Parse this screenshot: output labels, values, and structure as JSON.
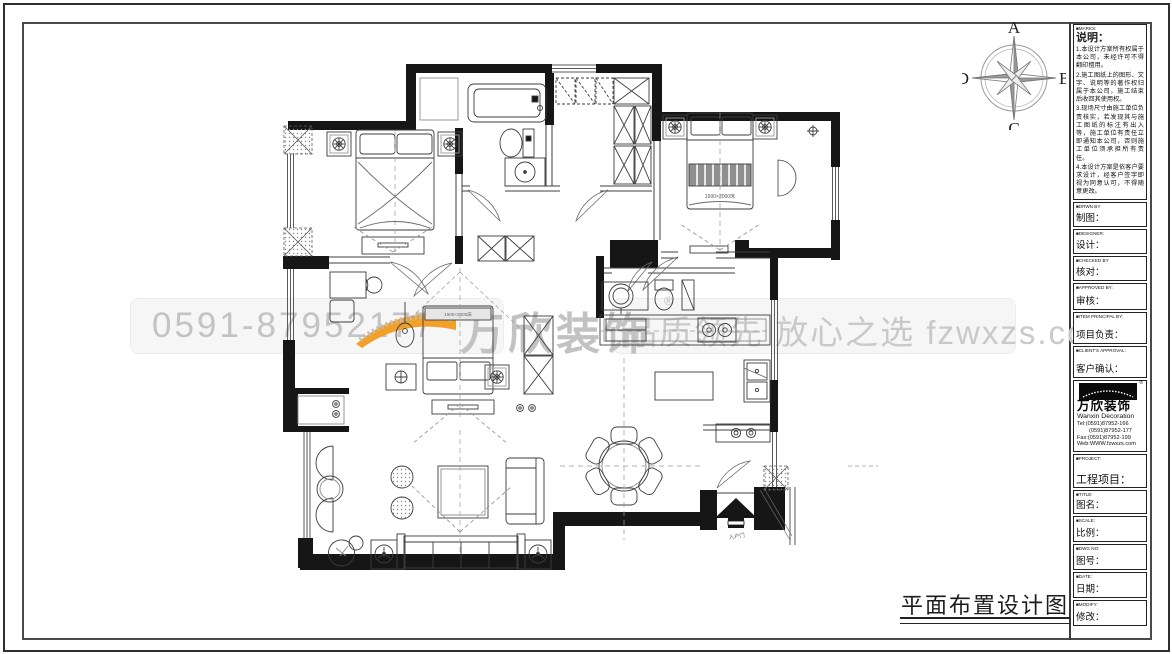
{
  "watermark": {
    "phone": "0591-87952177",
    "slogan": "品质领先 放心之选 fzwxzs.com",
    "logo_text": "万欣装饰",
    "reg_mark": "®",
    "accent_color": "#f3a028",
    "text_color": "#c3c3c3"
  },
  "compass": {
    "n": "A",
    "e": "B",
    "s": "C",
    "w": "D"
  },
  "drawing": {
    "title": "平面布置设计图",
    "bed_label": "1500×2000床",
    "bed_label2": "1500×2000床",
    "entrance_label": "入户门"
  },
  "titleblock": {
    "notes": {
      "en": "■MARKS:",
      "zh": "说明：",
      "items": [
        "1.本设计方案所有权属于本公司，未经许可不得翻印擅用。",
        "2.施工图纸上的图形、文字、说明等的著作权归属于本公司，施工结束后收回其使用权。",
        "3.现场尺寸由施工单位负责核实，若发现其与施工图纸的标注有出入等，施工单位有责任立即通知本公司，否则施工单位须承担所有责任。",
        "4.本设计方案是依客户要求设计，经客户签字即视为同意认可，不得随意更改。"
      ]
    },
    "fields": [
      {
        "en": "■DRWN BY",
        "zh": "制图："
      },
      {
        "en": "■DESIGNER:",
        "zh": "设计："
      },
      {
        "en": "■CHECKED BY",
        "zh": "核对："
      },
      {
        "en": "■APPROVED BY:",
        "zh": "审核："
      },
      {
        "en": "■ITEM PRINCIPAL BY:",
        "zh": "项目负责："
      },
      {
        "en": "■CLIENT'S APPROVAL:",
        "zh": "客户确认："
      }
    ],
    "company": {
      "logo_cn": "万欣装饰",
      "logo_en": "Wanxin Decoration",
      "reg": "®",
      "tel1": "Tel:(0591)87952-166",
      "tel2": "(0591)87952-177",
      "fax": "Fax:(0591)87952-199",
      "web": "Web:WWW.fzwxzs.com"
    },
    "fields2": [
      {
        "en": "■PROJECT:",
        "zh": "工程项目："
      },
      {
        "en": "■TITLE:",
        "zh": "图名："
      },
      {
        "en": "■SCALE:",
        "zh": "比例："
      },
      {
        "en": "■DWG NO:",
        "zh": "图号："
      },
      {
        "en": "■DATE:",
        "zh": "日期："
      },
      {
        "en": "■MODIFY:",
        "zh": "修改："
      }
    ]
  }
}
